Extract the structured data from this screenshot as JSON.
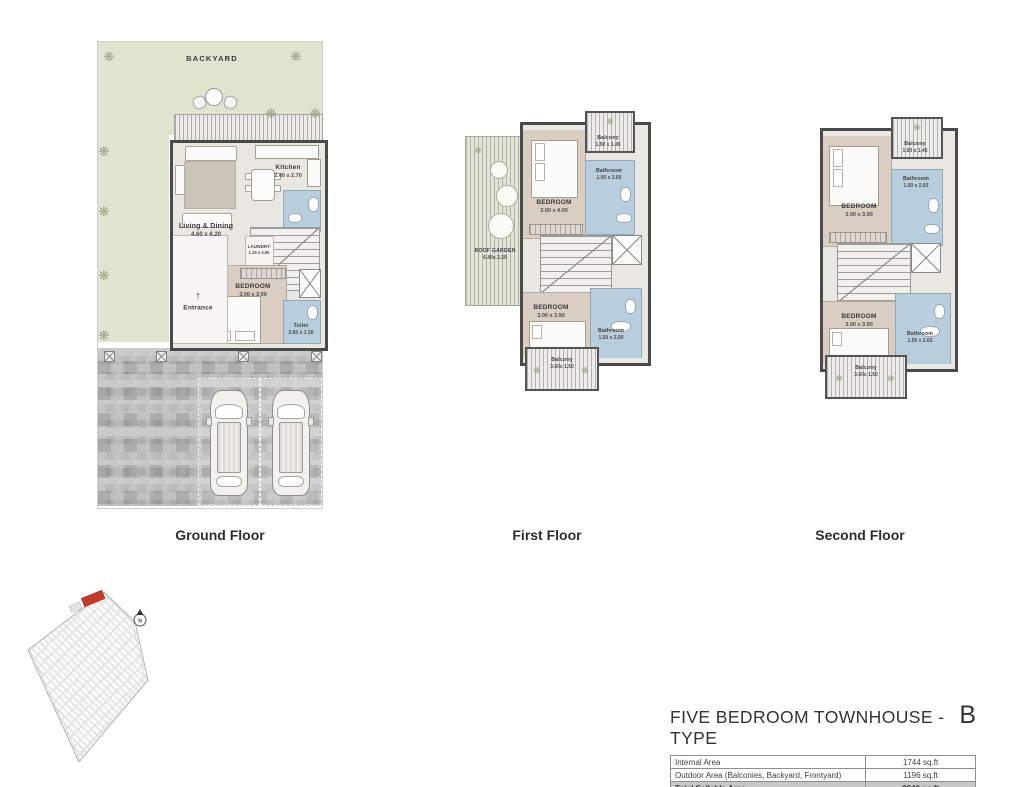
{
  "colors": {
    "backyard_green": "#dfe4cf",
    "bedroom_beige": "#d9cec1",
    "bathroom_blue": "#b9cedd",
    "wall_dark": "#4a4a4a",
    "highlight_red": "#c23a2b",
    "driveway_gray": "#b3b3b3",
    "total_row_gray": "#c7c7c7"
  },
  "icons": {
    "tree": "❋"
  },
  "floors": {
    "ground": {
      "title": "Ground Floor",
      "backyard": "BACKYARD",
      "kitchen": {
        "name": "Kitchen",
        "dim": "2.40 x 2.70"
      },
      "living": {
        "name": "Living & Dining",
        "dim": "4.60 x 6.20"
      },
      "laundry": {
        "name": "LAUNDRY",
        "dim": "1.15 x 0.95"
      },
      "bedroom": {
        "name": "BEDROOM",
        "dim": "3.00 x 3.90"
      },
      "entrance": {
        "name": "Entrance",
        "arrow": "↑"
      },
      "toilet": {
        "name": "Toilet",
        "dim": "2.60 x 1.50"
      }
    },
    "first": {
      "title": "First Floor",
      "roof_garden": {
        "name": "ROOF GARDEN",
        "dim": "6.40x 2.20"
      },
      "balcony_top": {
        "name": "Balcony",
        "dim": "1.50 x 1.45"
      },
      "bedroom_top": {
        "name": "BEDROOM",
        "dim": "3.00 x 4.00"
      },
      "bathroom_top": {
        "name": "Bathroom",
        "dim": "1.50 x 2.60"
      },
      "bedroom_bottom": {
        "name": "BEDROOM",
        "dim": "3.00 x 3.90"
      },
      "bathroom_bottom": {
        "name": "Bathroom",
        "dim": "1.50 x 2.60"
      },
      "balcony_bottom": {
        "name": "Balcony",
        "dim": "3.60x 1.50"
      }
    },
    "second": {
      "title": "Second Floor",
      "balcony_top": {
        "name": "Balcony",
        "dim": "1.60 x 1.45"
      },
      "bedroom_top": {
        "name": "BEDROOM",
        "dim": "3.00 x 3.90"
      },
      "bathroom_top": {
        "name": "Bathroom",
        "dim": "1.50 x 2.65"
      },
      "bedroom_bottom": {
        "name": "BEDROOM",
        "dim": "3.00 x 3.90"
      },
      "bathroom_bottom": {
        "name": "Bathroom",
        "dim": "1.50 x 2.65"
      },
      "balcony_bottom": {
        "name": "Balcony",
        "dim": "3.60x 1.50"
      }
    }
  },
  "site_plan": {
    "north_label": "N"
  },
  "summary": {
    "title": "FIVE BEDROOM TOWNHOUSE - TYPE",
    "type_letter": "B",
    "rows": [
      {
        "label": "Internal Area",
        "value": "1744 sq.ft"
      },
      {
        "label": "Outdoor Area (Balconies, Backyard, Frontyard)",
        "value": "1196 sq.ft"
      },
      {
        "label": "Total Sellable Area",
        "value": "2940 sq.ft"
      }
    ]
  }
}
